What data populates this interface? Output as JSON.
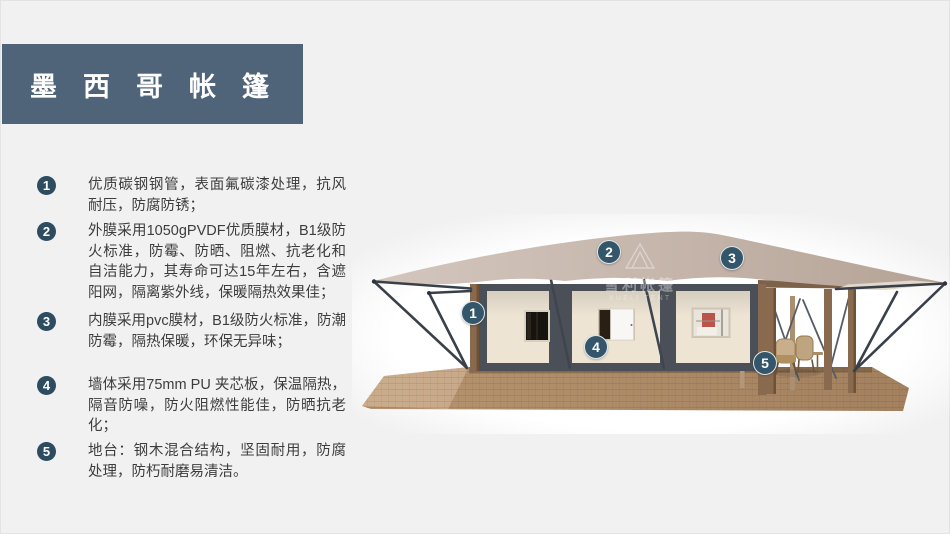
{
  "title": {
    "text": "墨西哥帐篷"
  },
  "features": {
    "items": [
      {
        "num": "1",
        "text": "优质碳钢钢管，表面氟碳漆处理，抗风耐压，防腐防锈；"
      },
      {
        "num": "2",
        "text": "外膜采用1050gPVDF优质膜材，B1级防火标准，防霉、防晒、阻燃、抗老化和自洁能力，其寿命可达15年左右，含遮阳网，隔离紫外线，保暖隔热效果佳；"
      },
      {
        "num": "3",
        "text": "内膜采用pvc膜材，B1级防火标准，防潮防霉，隔热保暖，环保无异味；"
      },
      {
        "num": "4",
        "text": "墙体采用75mm PU 夹芯板，保温隔热，隔音防噪，防火阻燃性能佳，防晒抗老化；"
      },
      {
        "num": "5",
        "text": "地台：钢木混合结构，坚固耐用，防腐处理，防朽耐磨易清洁。"
      }
    ]
  },
  "tent": {
    "callouts": [
      {
        "num": "1"
      },
      {
        "num": "2"
      },
      {
        "num": "3"
      },
      {
        "num": "4"
      },
      {
        "num": "5"
      }
    ],
    "watermark": {
      "cn": "雪利帐篷",
      "en": "XUELI TENT"
    }
  },
  "colors": {
    "page_bg": "#f1f1f2",
    "banner_bg": "#4f6478",
    "banner_text": "#ffffff",
    "badge_bg": "#2d4c60",
    "callout_bg": "#34566a",
    "body_text": "#3d3d3d",
    "wall": "#ede4d4",
    "frame": "#4b5058",
    "wood": "#8a6a4e",
    "steel": "#3a404a"
  }
}
